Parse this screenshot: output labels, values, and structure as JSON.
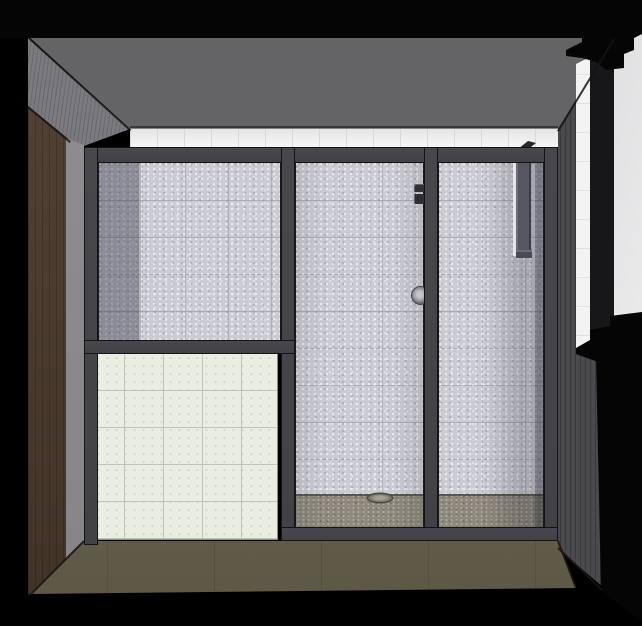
{
  "scene": {
    "type": "3d-interior-rendering",
    "subject": "bathroom with framed glass shower enclosure, tiled half wall, window and wood-tone wall",
    "visible_text": "none"
  },
  "colors": {
    "background": "#000000",
    "ceiling": "#646467",
    "left_wall_upper": "#7a7a7f",
    "left_wall_brown": "#4a392c",
    "return_edge": "#8f8f91",
    "tile_strip": "#f2f2f4",
    "tile_strip_grout": "#d9d9dc",
    "frame": "#48484c",
    "frame_outline": "#141416",
    "glass_tile": "#cbcbd3",
    "half_wall_tile": "#eaede1",
    "half_wall_grout": "#bfc4b6",
    "shower_pan": "#8e897c",
    "floor": "#6b654f",
    "right_wall": "#4a4a4e",
    "window_trim": "#f3f3f4",
    "window_frame_dark": "#151517",
    "window_frame_mid": "#5a5a61",
    "window_glass_light": "#f1f1f2",
    "window_glass_dim": "#97979c",
    "shadow_black": "#050505",
    "fixture_dark": "#2f2f34",
    "knob_metal": "#9a9aa2"
  }
}
